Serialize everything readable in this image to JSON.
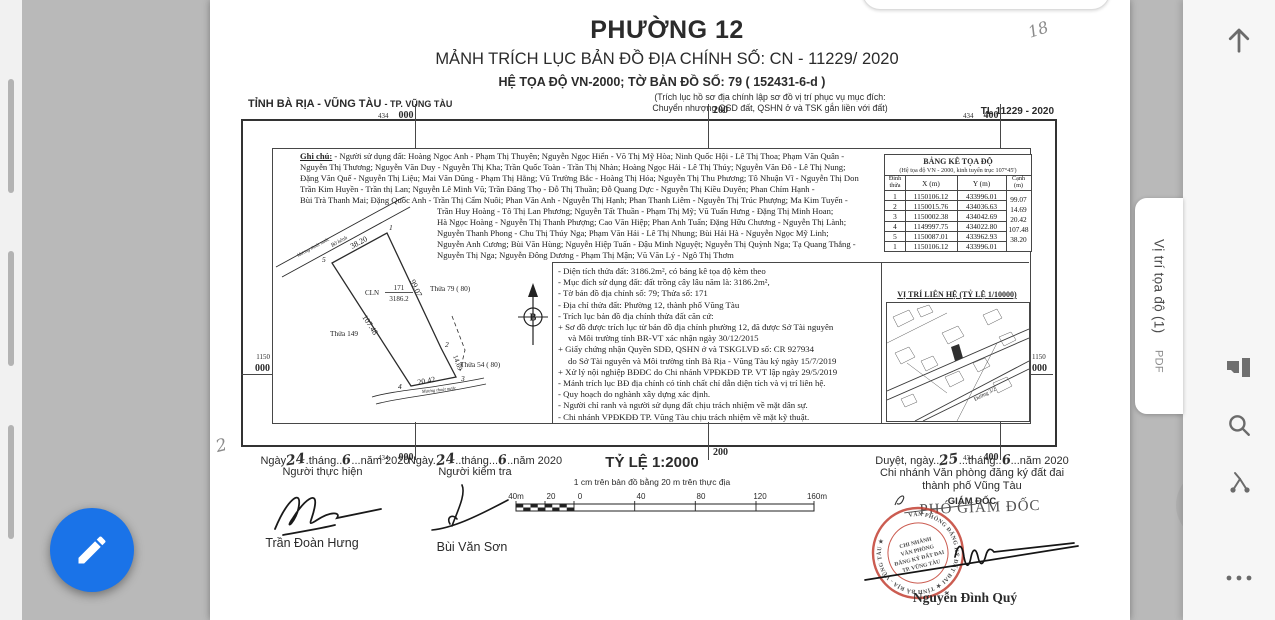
{
  "viewer": {
    "file_tab": {
      "title": "Vị trí tọa độ (1)",
      "badge": "PDF"
    },
    "icons": {
      "up": "up-arrow",
      "pages": "page-view",
      "search": "search",
      "path": "node-path",
      "more": "more-options",
      "fab": "edit-pencil"
    }
  },
  "annotations": {
    "top_right": "18",
    "bottom_left": "2"
  },
  "document": {
    "title": "PHƯỜNG 12",
    "subtitle": "MẢNH TRÍCH LỤC BẢN ĐỒ ĐỊA CHÍNH SỐ: CN - 11229/ 2020",
    "coord_system": "HỆ TỌA ĐỘ VN-2000;  TỜ BẢN ĐỒ SỐ: 79 ( 152431-6-d )",
    "purpose1": "(Trích lục hồ sơ địa chính lập sơ đồ vị trí phục vụ mục đích:",
    "purpose2": "Chuyển nhượng QSD đất, QSHN ở và TSK gắn liền với đất)",
    "province": "TỈNH BÀ RỊA - VŨNG TÀU",
    "city": "- TP. VŨNG TÀU",
    "sheet_code": "TL 11229 - 2020",
    "grid": {
      "x1a": "434",
      "x1b": "000",
      "x2": "200",
      "x3a": "434",
      "x3b": "400",
      "ya": "1150",
      "yb": "000"
    },
    "ghi_chu": {
      "label": "Ghi chú:",
      "lines": [
        "- Người sử dụng đất: Hoàng Ngọc Anh - Phạm Thị Thuyên; Nguyễn Ngọc Hiển - Võ Thị Mỹ Hòa; Ninh Quốc Hội - Lê Thị Thoa; Phạm Văn Quân -",
        "Nguyễn Thị Thương; Nguyễn Văn Duy - Nguyễn Thị Kha; Trần Quốc Toàn - Trần Thị Nhàn; Hoàng Ngọc Hải - Lê Thị Thúy; Nguyễn Văn Đô - Lê Thị Nung;",
        "Đặng Văn Quế - Nguyễn Thị Liệu; Mai Văn Dũng - Phạm Thị Hằng; Vũ Trường Bắc - Hoàng Thị Hóa; Nguyễn Thị Thu Phương; Tô Nhuận Vĩ - Nguyễn Thị Don",
        "Trần Kim Huyền - Trần thị Lan; Nguyễn Lê Minh Vũ; Trần Đăng Thọ - Đỗ Thị Thuần; Đỗ Quang Dực - Nguyễn Thị Kiều Duyên; Phan Chím Hạnh -",
        "Bùi Trà Thanh Mai; Đặng Quốc Anh - Trần Thị Cẩm Nuôi; Phan Văn Anh - Nguyễn Thị Hạnh; Phan Thanh Liêm - Nguyễn Thị Trúc Phượng; Ma Kim Tuyến -",
        "Trần Huy Hoàng - Tô Thị Lan Phương; Nguyễn Tất Thuần - Phạm Thị Mỹ; Vũ Tuấn Hưng - Đặng Thị Minh Hoan;",
        "Hà Ngọc Hoàng - Nguyễn Thị Thanh Phượng; Cao Văn Hiệp; Phan Anh Tuấn; Đặng Hữu Chương - Nguyễn Thị Lành;",
        "Nguyễn Thanh Phong - Chu Thị Thúy Nga; Phạm Văn Hải - Lê Thị Nhung; Bùi Hải Hà - Nguyễn Ngọc Mỹ Linh;",
        "Nguyễn Anh Cương; Bùi Văn Hùng; Nguyễn Hiệp Tuấn - Đậu Minh Nguyệt; Nguyễn Thị Quỳnh Nga; Tạ Quang Thắng -",
        "Nguyễn Thị Nga; Nguyễn Đông Dương - Phạm Thị Mận; Vũ Văn Lý - Ngô Thị Thơm"
      ]
    },
    "coords_table": {
      "title": "BẢNG KÊ TỌA ĐỘ",
      "subtitle": "(Hệ tọa độ VN - 2000, kinh tuyến trục 107°45')",
      "h_dinh1": "Đỉnh",
      "h_dinh2": "thửa",
      "h_x": "X (m)",
      "h_y": "Y (m)",
      "h_canh1": "Cạnh",
      "h_canh2": "(m)",
      "rows": [
        {
          "d": "1",
          "x": "1150106.12",
          "y": "433996.01"
        },
        {
          "d": "2",
          "x": "1150015.76",
          "y": "434036.63"
        },
        {
          "d": "3",
          "x": "1150002.38",
          "y": "434042.69"
        },
        {
          "d": "4",
          "x": "1149997.75",
          "y": "434022.80"
        },
        {
          "d": "5",
          "x": "1150087.01",
          "y": "433962.93"
        },
        {
          "d": "1",
          "x": "1150106.12",
          "y": "433996.01"
        }
      ],
      "canh": [
        "99.07",
        "14.69",
        "20.42",
        "107.48",
        "38.20"
      ]
    },
    "info_lines": [
      "- Diện tích thửa đất: 3186.2m², có bảng kê tọa độ kèm theo",
      "- Mục đích sử dụng đất: đất trồng cây lâu năm là: 3186.2m²,",
      "- Tờ bản đồ địa chính số:  79; Thửa số: 171",
      "- Địa chỉ thửa đất: Phường 12, thành phố Vũng Tàu",
      "- Trích lục bản đồ địa chính thửa đất căn cứ:",
      "+ Sơ đồ được trích lục từ bản đồ địa chính phường 12, đã được Sở Tài nguyên",
      "và Môi trường tỉnh BR-VT xác nhận ngày 30/12/2015",
      "+ Giấy chứng nhận Quyền SDĐ, QSHN ở và TSKGLVĐ số: CR 927934",
      "do Sở Tài nguyên và Môi trường tỉnh Bà Rịa - Vũng Tàu ký ngày 15/7/2019",
      "+ Xử lý nội nghiệp BĐĐC do Chi nhánh VPĐKĐĐ TP. VT lập ngày 29/5/2019",
      "- Mảnh trích lục BĐ địa chính có tính chất chỉ dẫn diện tích và vị trí liên hệ.",
      "- Quy hoạch do nghành xây dựng xác định.",
      "- Người chỉ ranh và người sử dụng đất chịu trách nhiệm về mặt dân sự.",
      "- Chi nhánh VPĐKĐĐ TP. Vũng Tàu chịu trách nhiệm về mặt kỹ thuật."
    ],
    "sketch": {
      "cln": "CLN",
      "so_thua": "171",
      "dien_tich": "3186.2",
      "thua79": "Thửa 79 ( 80)",
      "thua149": "Thửa 149",
      "thua54": "Thửa 54 ( 80)",
      "e51": "38.20",
      "e12": "99.07",
      "e23": "14.69",
      "e34": "20.42",
      "e45": "107.48",
      "v1": "1",
      "v2": "2",
      "v3": "3",
      "v4": "4",
      "v5": "5",
      "muong1": "Mương thoát nước",
      "bo_kenh": "Bờ kênh",
      "muong2": "Mương thoát nước",
      "north": "B"
    },
    "vicinity": {
      "title": "VỊ TRÍ LIÊN HỆ (TỶ LỆ 1/10000)",
      "street": "Đường 3/2"
    },
    "scale": {
      "title": "TỶ LỆ 1:2000",
      "note": "1 cm trên bản đồ bằng 20 m trên thực địa",
      "ticks": [
        "40m",
        "20",
        "0",
        "40",
        "80",
        "120",
        "160m"
      ]
    },
    "sig1": {
      "p1": "Ngày",
      "day": "24",
      "p2": ".tháng..",
      "month": "6",
      "p3": "...năm 2020",
      "role": "Người thực hiện",
      "name": "Trần Đoàn Hưng"
    },
    "sig2": {
      "p1": "Ngày.",
      "day": "24",
      "p2": "..tháng...",
      "month": "6",
      "p3": "..năm 2020",
      "role": "Người kiểm tra",
      "name": "Bùi Văn Sơn"
    },
    "approve": {
      "p1": "Duyệt, ngày..",
      "day": "25",
      "p2": "...tháng..",
      "month": "6",
      "p3": "...năm 2020",
      "org1": "Chi nhánh Văn phòng đăng ký đất đai",
      "org2": "thành phố Vũng Tàu",
      "role": "GIÁM ĐỐC",
      "role2": "PHÓ GIÁM ĐỐC",
      "name": "Nguyễn Đình Quý"
    },
    "stamp": {
      "ring": "VĂN PHÒNG ĐĂNG KÝ ĐẤT ĐAI ★ TỈNH BÀ RỊA - VŨNG TÀU ★",
      "l1": "CHI NHÁNH",
      "l2": "VĂN PHÒNG",
      "l3": "ĐĂNG KÝ ĐẤT ĐAI",
      "l4": "TP. VŨNG TÀU",
      "color": "#c0392b"
    },
    "accent_blue": "#1a73e8"
  }
}
